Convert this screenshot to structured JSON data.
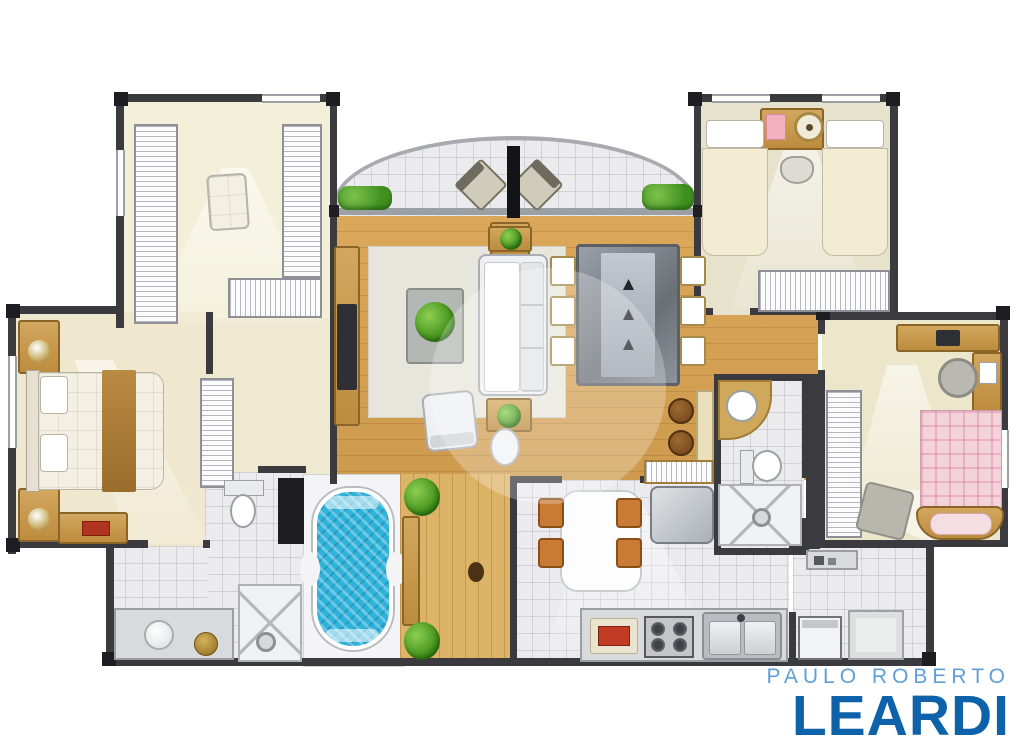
{
  "brand": {
    "line1": "PAULO ROBERTO",
    "line2": "LEARDI",
    "line1_color": "#5f9fd8",
    "line2_color": "#0e62a9"
  },
  "palette": {
    "wall": "#3a3a3f",
    "wood_floor": "#d9a352",
    "deck_floor": "#ddb467",
    "tile_floor": "#ebebee",
    "cream_floor": "#f1ecd4",
    "spa_water": "#30b3da",
    "plant_green": "#46951f",
    "platform": "#f4f4f6"
  }
}
